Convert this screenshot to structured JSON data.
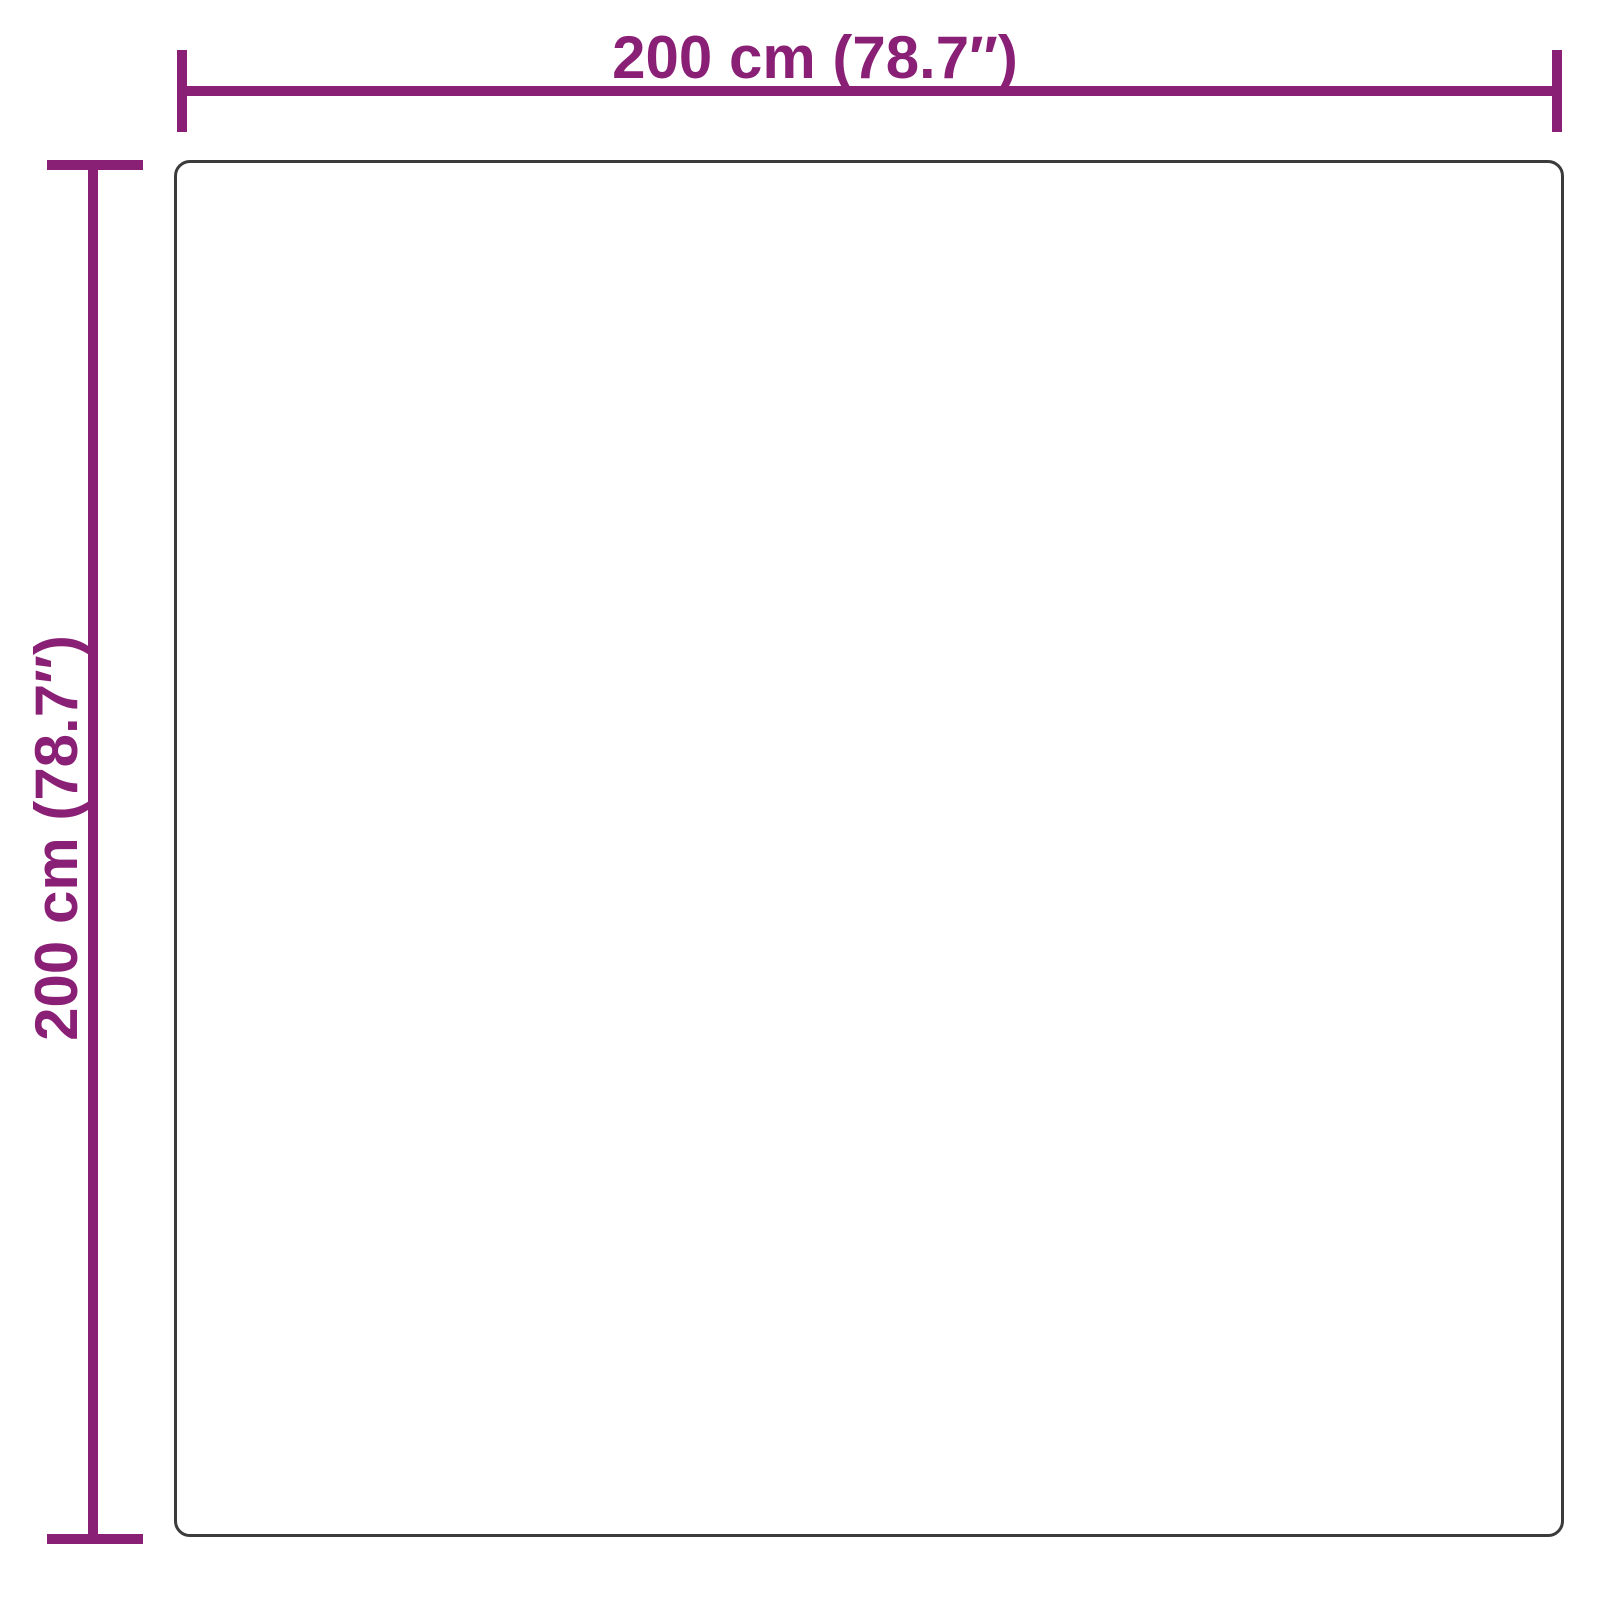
{
  "diagram": {
    "kind": "product-dimension-diagram",
    "shape": "square-with-rounded-corners",
    "colors": {
      "dimension": "#8A2076",
      "outline": "#3B3B3B",
      "background": "#FFFFFF"
    },
    "width_dimension": {
      "label": "200 cm (78.7″)",
      "cm": 200,
      "inches": 78.7
    },
    "height_dimension": {
      "label": "200 cm (78.7″)",
      "cm": 200,
      "inches": 78.7
    }
  }
}
